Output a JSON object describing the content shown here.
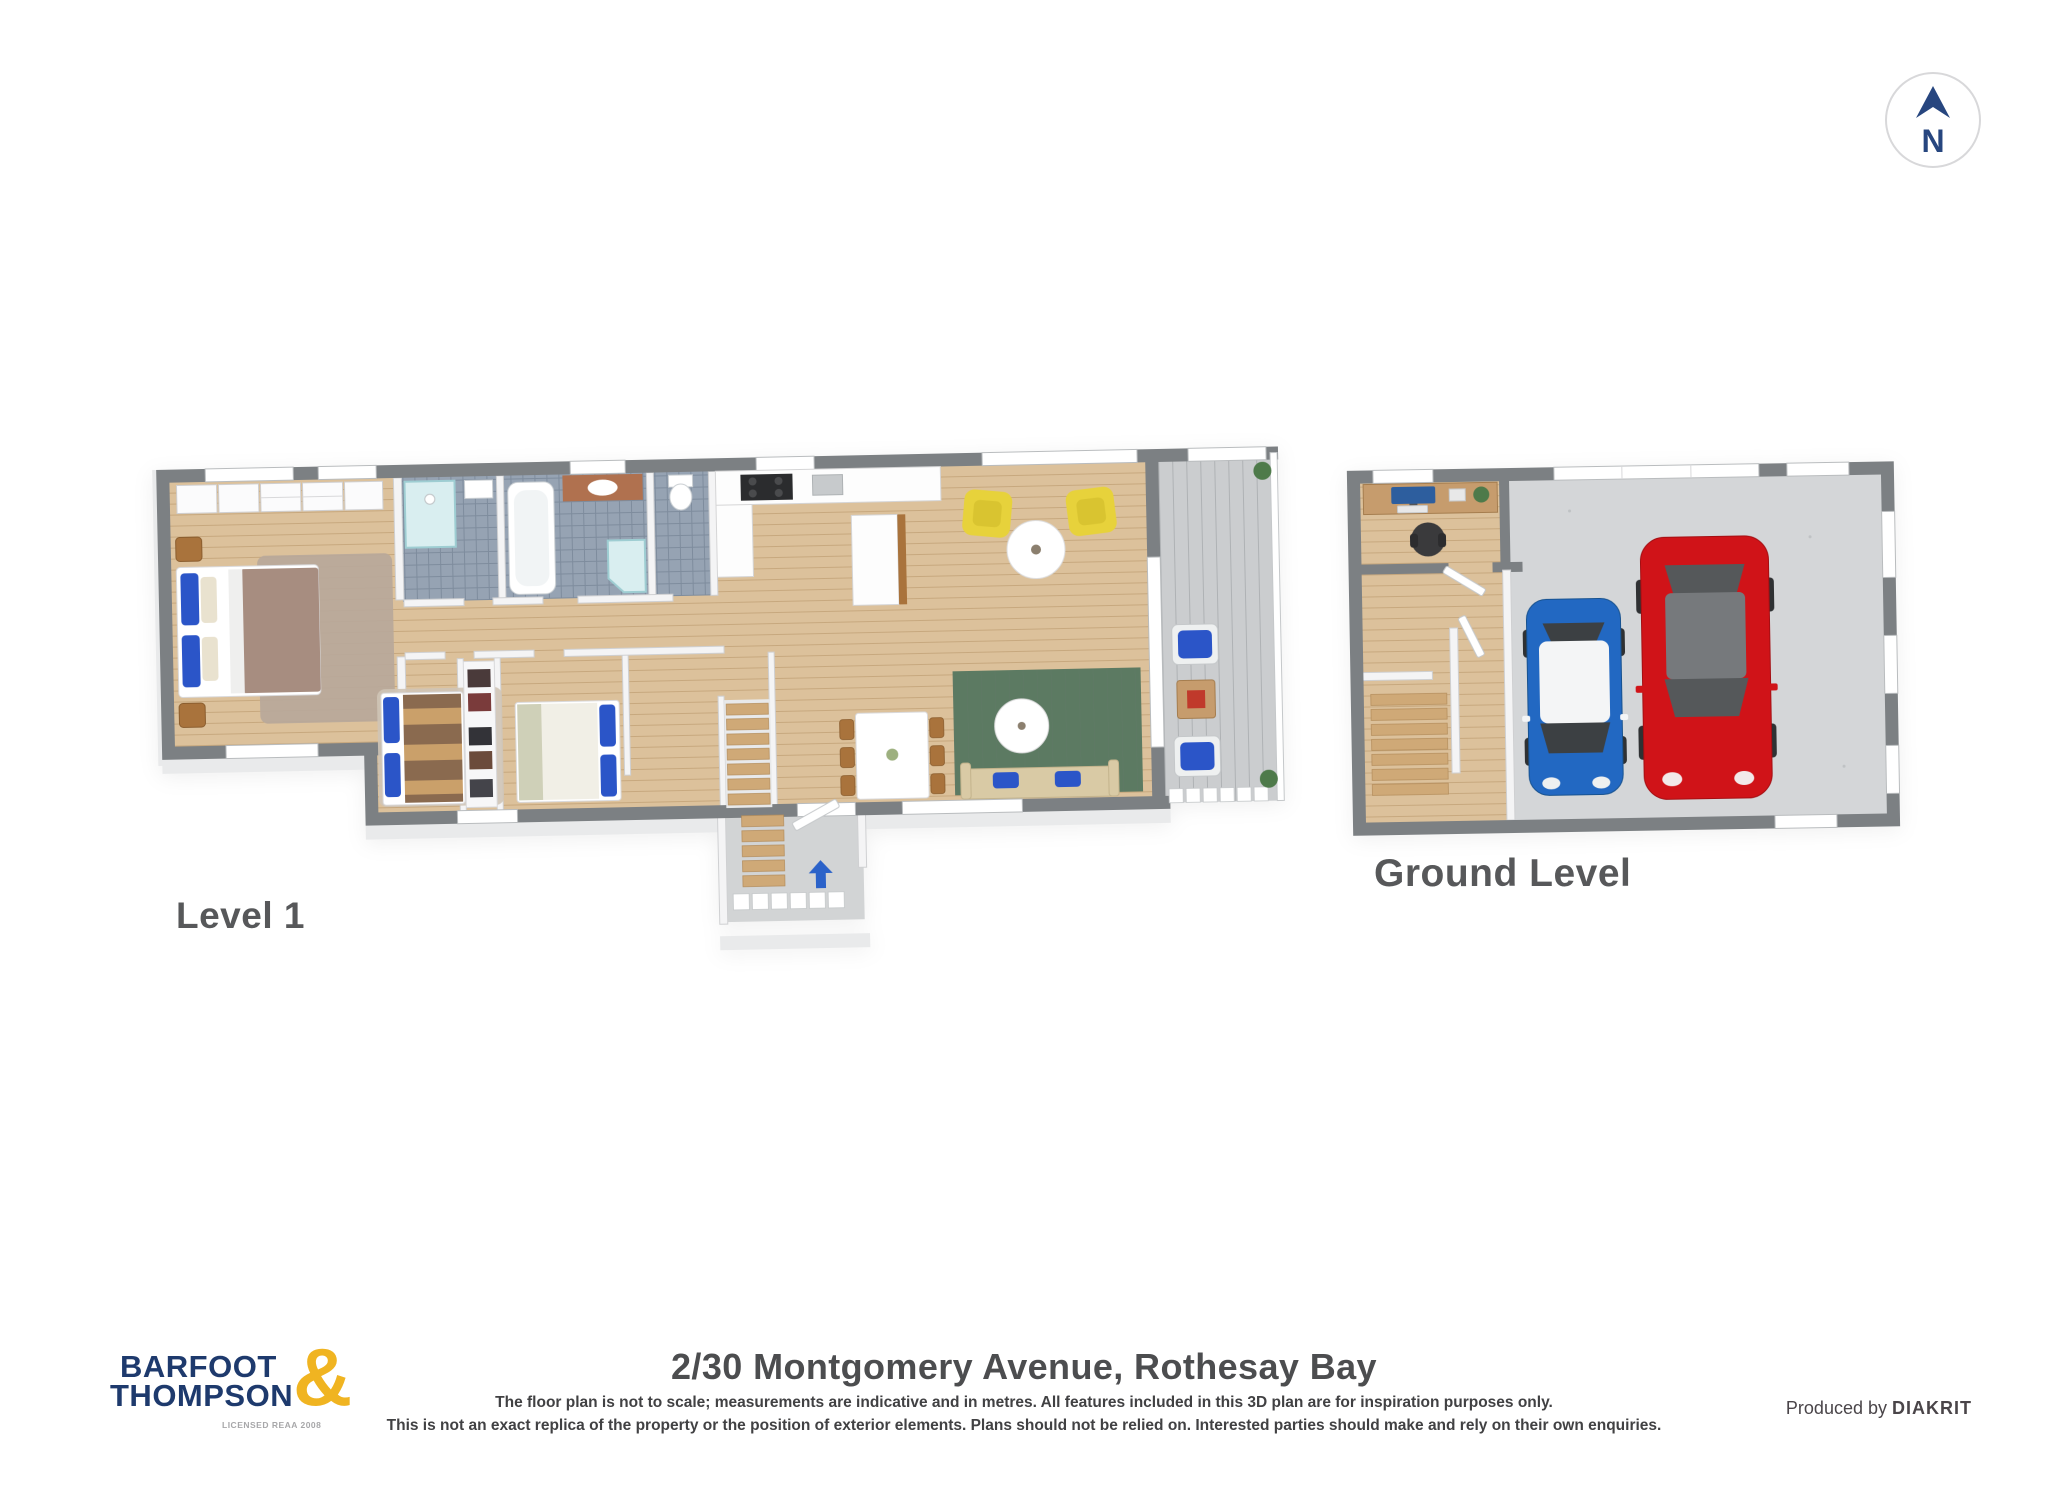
{
  "compass": {
    "label": "N"
  },
  "plans": {
    "level1": {
      "label": "Level 1",
      "rooms": [
        "master bedroom",
        "ensuite",
        "bathroom",
        "wc",
        "kitchen",
        "hallway",
        "bedroom 2",
        "wardrobe",
        "bedroom 3",
        "dining",
        "living",
        "deck",
        "entry stairs"
      ]
    },
    "ground": {
      "label": "Ground Level",
      "rooms": [
        "office nook",
        "hallway stairs",
        "double garage"
      ]
    }
  },
  "footer": {
    "logo": {
      "word1": "BARFOOT",
      "word2": "THOMPSON",
      "amp": "&",
      "license": "LICENSED REAA 2008"
    },
    "address": "2/30 Montgomery Avenue, Rothesay Bay",
    "disclaimer_line1": "The floor plan is not to scale; measurements are indicative and in metres. All features included in this 3D plan are for inspiration purposes only.",
    "disclaimer_line2": "This is not an exact replica of the property or the position of exterior elements. Plans should not be relied on. Interested parties should make and rely on their own enquiries.",
    "produced_by": "Produced by ",
    "producer": "DIAKRIT"
  },
  "colors": {
    "brand_navy": "#1e3a6d",
    "brand_gold": "#f0b421",
    "wall_gray": "#7c8083",
    "wall_light": "#e9eaeb",
    "wood_floor": "#dcc19b",
    "tile_floor": "#96a3b3",
    "deck_gray": "#cbcdcf",
    "concrete_gray": "#d4d6d8",
    "car_red": "#d01318",
    "car_blue": "#2268c2",
    "armchair_yellow": "#e7d23b",
    "rug_green": "#5c7a62",
    "pillow_blue": "#2b55c8",
    "sofa_beige": "#d9caa5",
    "duvet_taupe": "#a78d80",
    "rug_taupe": "#b7a89a",
    "wood_brown": "#a9733c",
    "vanity_copper": "#b0714f",
    "entry_arrow_blue": "#2b62c9",
    "compass_navy": "#27467f",
    "label_gray": "#57585a"
  }
}
